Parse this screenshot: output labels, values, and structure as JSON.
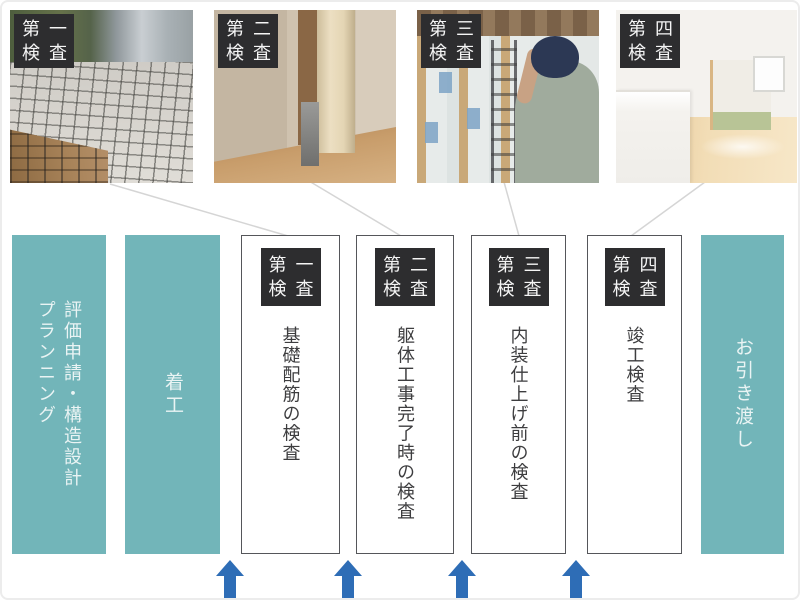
{
  "palette": {
    "teal": "#72b5b9",
    "teal_text": "#eaf4f4",
    "badge_bg": "#2d2d2f",
    "badge_text": "#f5f5f5",
    "box_border": "#55565a",
    "box_text": "#3d3d3f",
    "arrow_blue": "#2e6db6",
    "connector_gray": "#d5d5d5"
  },
  "photos": [
    {
      "badge": {
        "row1": "第一",
        "row2": "検査"
      }
    },
    {
      "badge": {
        "row1": "第二",
        "row2": "検査"
      }
    },
    {
      "badge": {
        "row1": "第三",
        "row2": "検査"
      }
    },
    {
      "badge": {
        "row1": "第四",
        "row2": "検査"
      }
    }
  ],
  "flow": {
    "planning": {
      "line1": "評価申請・構造設計",
      "line2": "プランニング"
    },
    "start": {
      "label": "着工"
    },
    "inspections": [
      {
        "badge": {
          "row1": "第一",
          "row2": "検査"
        },
        "body": "基礎配筋の検査"
      },
      {
        "badge": {
          "row1": "第二",
          "row2": "検査"
        },
        "body": "躯体工事完了時の検査"
      },
      {
        "badge": {
          "row1": "第三",
          "row2": "検査"
        },
        "body": "内装仕上げ前の検査"
      },
      {
        "badge": {
          "row1": "第四",
          "row2": "検査"
        },
        "body": "竣工検査"
      }
    ],
    "handover": {
      "label": "お引き渡し"
    }
  }
}
